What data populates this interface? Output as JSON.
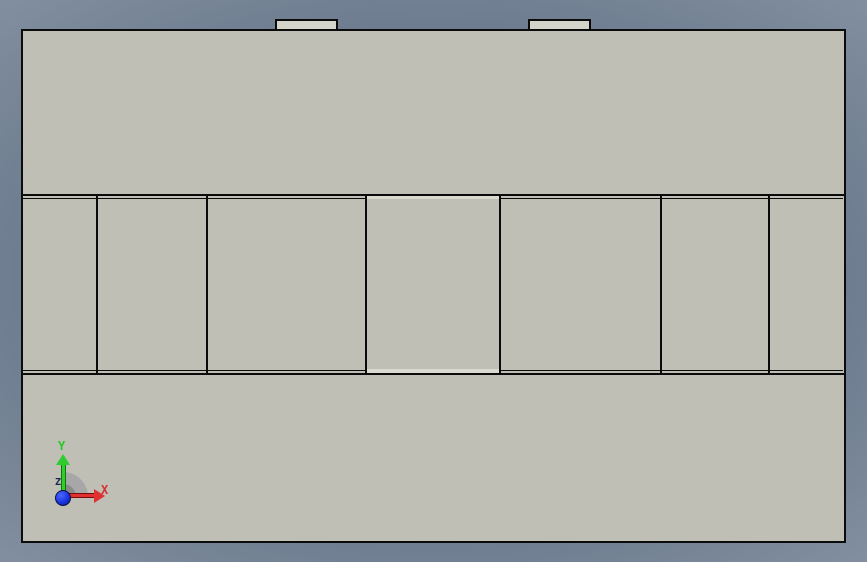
{
  "viewport": {
    "kind": "cad-3d-viewport",
    "background_center_color": "#5E6D80",
    "background_corner_color": "#B9C0CB"
  },
  "part": {
    "body_color": "#BFBFB5",
    "edge_color": "#0B0B0B",
    "tab_color": "#D4D4CA",
    "highlight_color": "#DADAD1",
    "tab_count": 2,
    "band_panel_count": 7
  },
  "triad": {
    "x_label": "X",
    "y_label": "Y",
    "z_label": "Z",
    "x_color": "#D42F2F",
    "y_color": "#28C828",
    "z_color": "#1C2250",
    "origin_color": "#1B35E0"
  }
}
